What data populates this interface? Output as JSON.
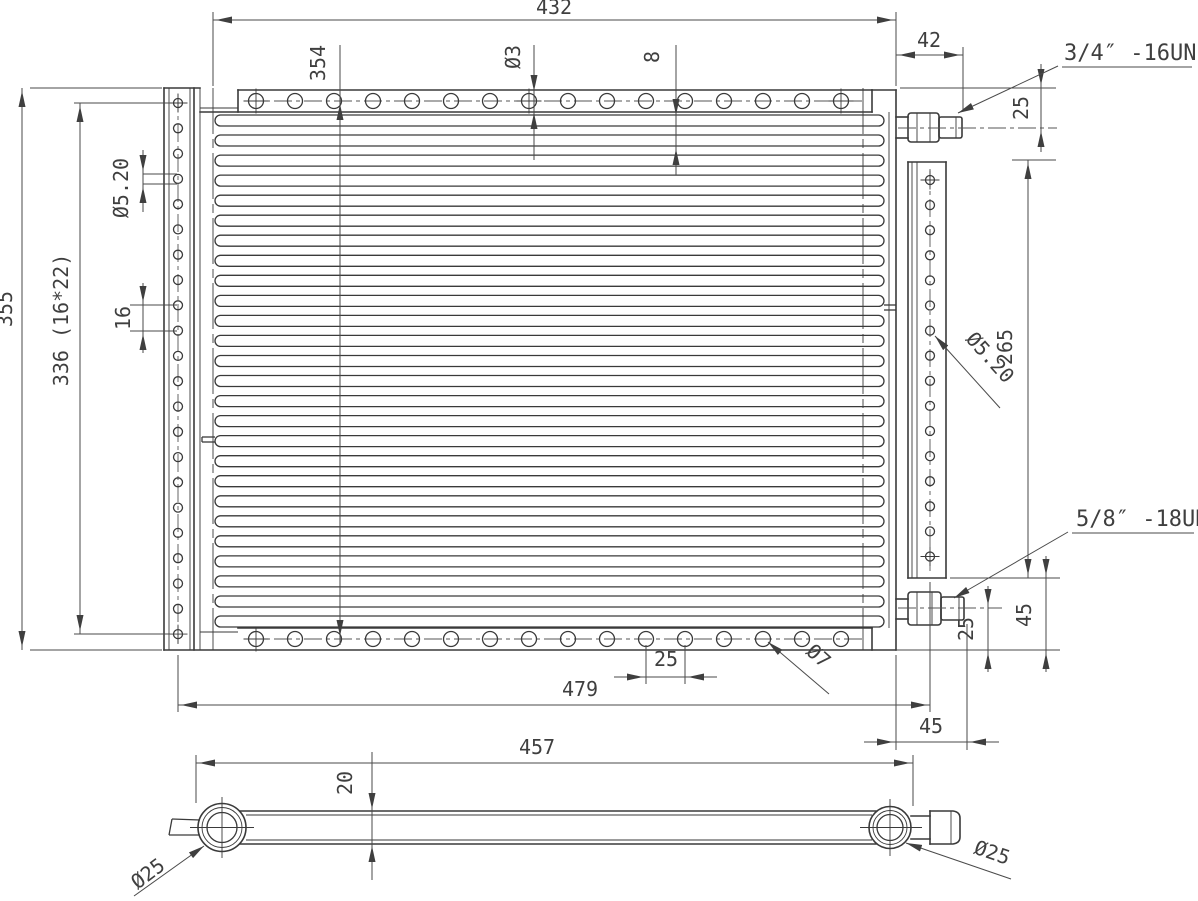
{
  "drawing": {
    "background": "#ffffff",
    "line_color": "#3a3a3a",
    "dim_color": "#4a4a4a",
    "text_color": "#3f3f3f",
    "counts": {
      "tube_rows": 26,
      "left_plate_holes": 22,
      "right_plate_holes": 16,
      "top_flange_holes": 16,
      "bottom_flange_holes": 16
    },
    "labels": {
      "overall_width": "432",
      "fitting_offset": "42",
      "top_fitting_thread": "3/4″ -16UNF",
      "top_fitting_center": "25",
      "hole_span_vertical": "354",
      "flange_hole_dia": "Ø3",
      "fin_gap": "8",
      "overall_height": "355",
      "side_hole_span": "336 (16*22)",
      "side_hole_dia_left": "Ø5.20",
      "side_hole_pitch": "16",
      "side_hole_dia_right": "Ø5.20",
      "right_hole_span": "265",
      "bottom_fitting_thread": "5/8″ -18UNF",
      "bottom_fitting_center": "25",
      "fitting_height": "45",
      "bottom_hole_dia": "Ø7",
      "flange_hole_pitch": "25",
      "bottom_width": "479",
      "fitting_protrusion": "45",
      "tube_length": "457",
      "tube_depth": "20",
      "tube_dia_left": "Ø25",
      "tube_dia_right": "Ø25"
    }
  }
}
